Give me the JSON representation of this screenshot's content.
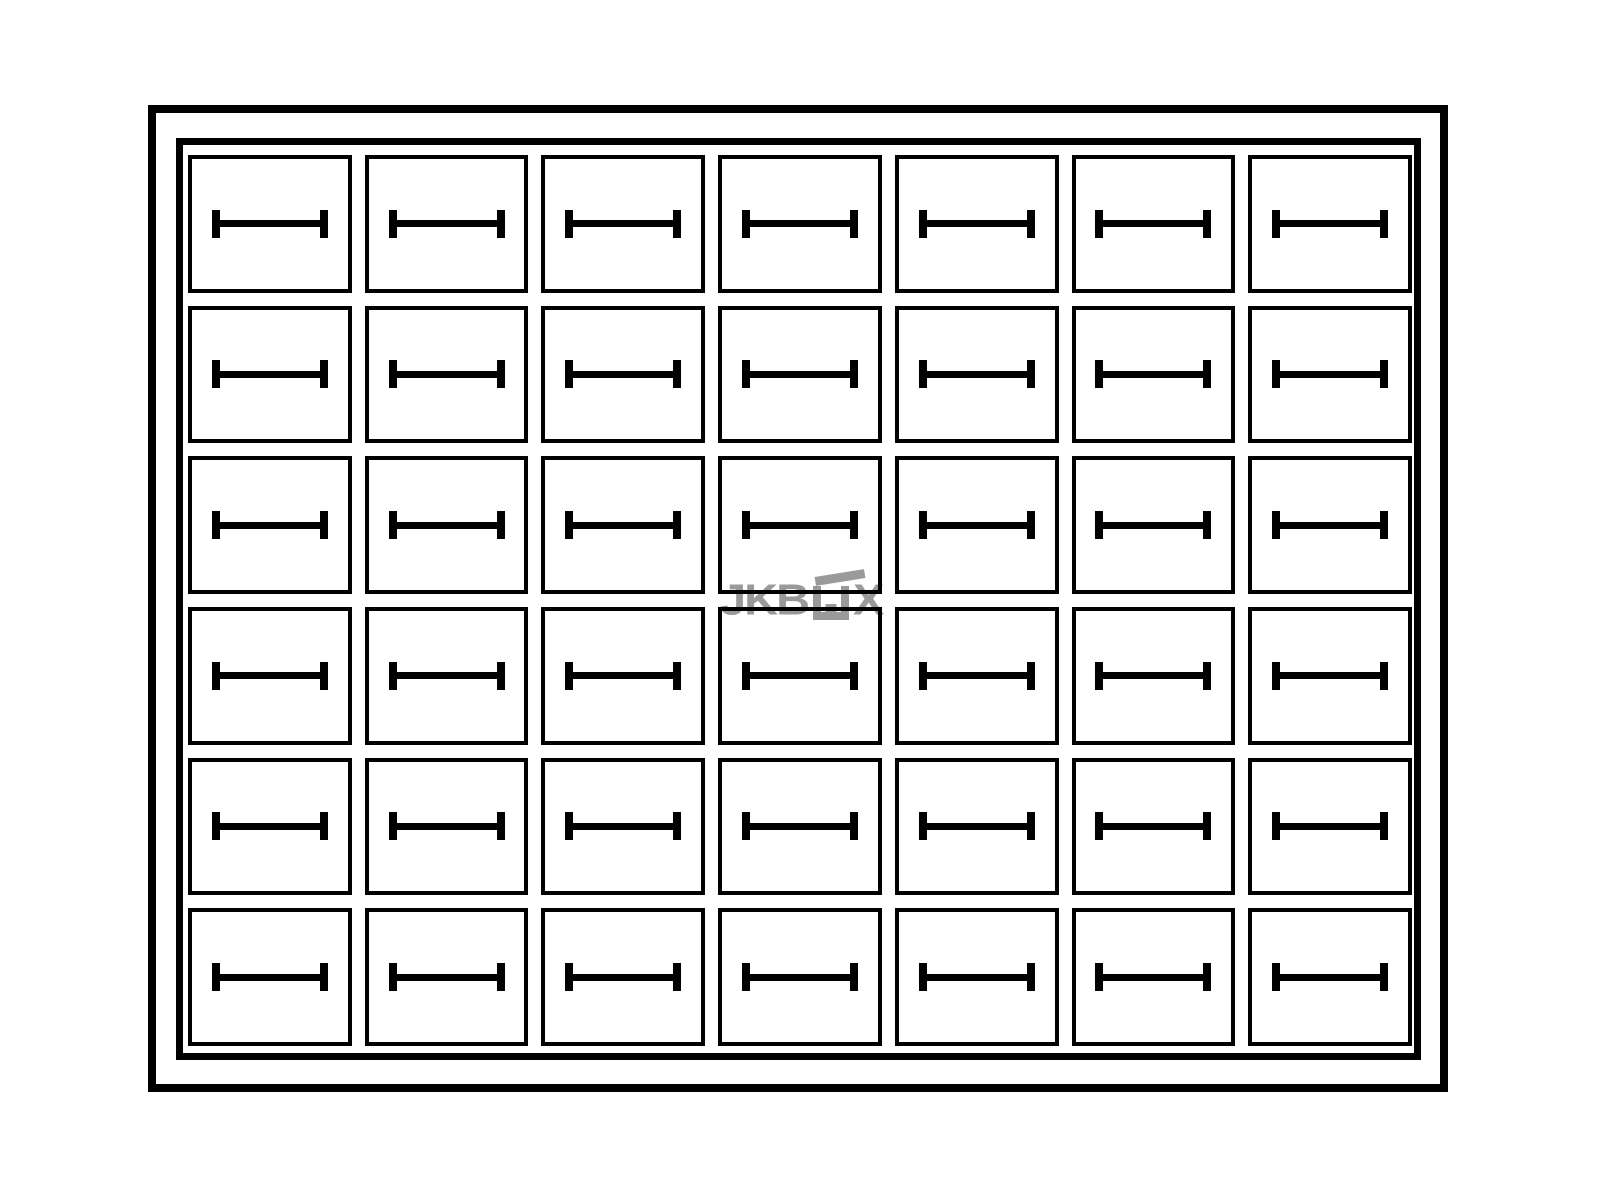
{
  "watermark": {
    "prefix": "JKB",
    "suffix": "X",
    "full_text": "JKBOX",
    "box_glyph": "open-box-icon",
    "color": "#9a9a9a"
  },
  "grid": {
    "rows": 6,
    "columns": 7,
    "cell_count": 42,
    "cell_icon": "drawer-handle-icon"
  },
  "colors": {
    "background": "#ffffff",
    "line": "#000000",
    "watermark": "#9a9a9a"
  }
}
